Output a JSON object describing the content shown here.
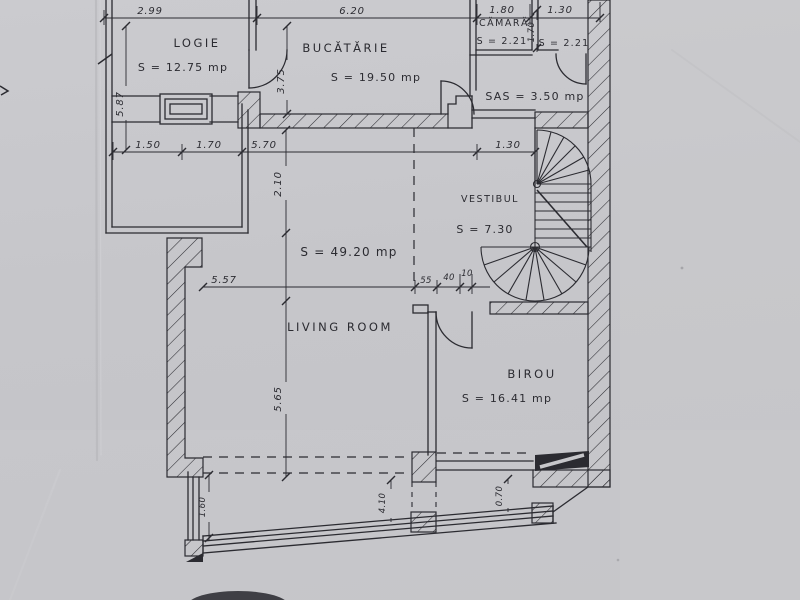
{
  "meta": {
    "title": "Scanned apartment floor plan",
    "drawing_type": "floor-plan",
    "language": "Romanian",
    "ink_color": "#2b2b31",
    "paper_color": "#c6c6ca"
  },
  "rooms": {
    "logie": {
      "name": "LOGIE",
      "area": "S = 12.75 mp"
    },
    "bucatarie": {
      "name": "BUCĂTĂRIE",
      "area": "S = 19.50 mp"
    },
    "camara": {
      "name": "CĂMARĂ",
      "area": "S = 2.21"
    },
    "camara2": {
      "area": "S = 2.21"
    },
    "sas": {
      "label": "SAS = 3.50 mp"
    },
    "vestibul": {
      "name": "VESTIBUL",
      "area": "S = 7.30"
    },
    "living": {
      "name": "LIVING ROOM",
      "area": "S = 49.20 mp"
    },
    "birou": {
      "name": "BIROU",
      "area": "S = 16.41 mp"
    }
  },
  "dimensions": {
    "top_row": {
      "d1": "2.99",
      "d2": "6.20",
      "d3": "1.80",
      "d4": "1.30"
    },
    "mid_row": {
      "d1": "1.50",
      "d2": "1.70",
      "d3": "5.70",
      "d4": "1.30"
    },
    "living_row": {
      "d1": "5.57",
      "d2": "55",
      "d3": "40",
      "d4": "10"
    },
    "vertical": {
      "logie_height": "5.87",
      "kitchen_door": "3.75",
      "camara_depth": "1.70",
      "hall_width": "2.10",
      "living_height": "5.65"
    },
    "bottom_row": {
      "d1": "1.60",
      "d2": "4.10",
      "d3": "0.70"
    }
  }
}
